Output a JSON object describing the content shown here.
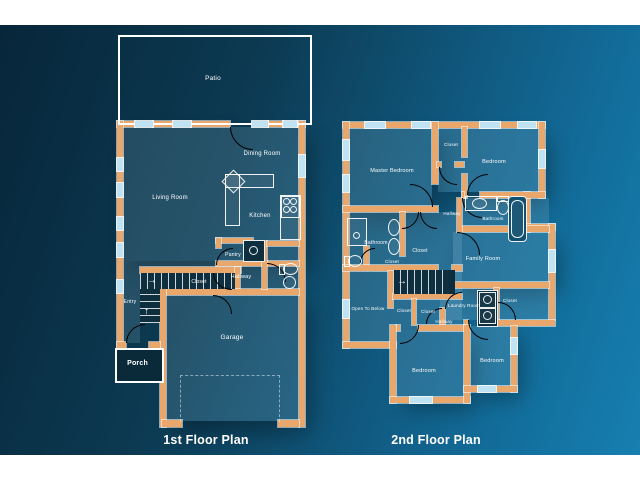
{
  "palette": {
    "background_dark": "#07263a",
    "background_light": "#1478a8",
    "letterbox": "#ffffff",
    "wall": "#e9a76c",
    "window": "#bfe3f2",
    "door_line": "#ffffff",
    "room_fill": "rgba(173,216,236,0.16)",
    "dark_fill": "#0c2d3e",
    "label_color": "#ffffff"
  },
  "floor1": {
    "title": "1st Floor Plan",
    "rooms": {
      "patio": "Patio",
      "dining_room": "Dining Room",
      "living_room": "Living Room",
      "kitchen": "Kitchen",
      "pantry": "Pantry",
      "hallway": "Hallway",
      "closet": "Closet",
      "entry": "Entry",
      "garage": "Garage",
      "porch": "Porch"
    }
  },
  "floor2": {
    "title": "2nd Floor Plan",
    "rooms": {
      "master_bedroom": "Master Bedroom",
      "closet_top": "Closet",
      "bedroom_top": "Bedroom",
      "hallway_upper": "Hallway",
      "bathroom_right": "Bathroom",
      "bathroom_left": "Bathroom",
      "closet_walkin": "Closet",
      "closet_small": "Closet",
      "family_room": "Family Room",
      "open_to_below": "Open To Below",
      "closet_a": "Closet",
      "closet_b": "Closet",
      "laundry_room": "Laundry Room",
      "closet_right": "Closet",
      "hallway_lower": "Hallway",
      "bedroom_left": "Bedroom",
      "bedroom_right": "Bedroom"
    }
  },
  "arrows": {
    "up": "↑",
    "right": "→"
  },
  "icons": {
    "stove-icon": "four burner circles",
    "sink-icon": "oval basin",
    "toilet-icon": "bowl with tank",
    "bathtub-icon": "rounded tub",
    "shower-icon": "square with drain",
    "washer-icon": "square with circle",
    "dryer-icon": "square with circle",
    "stairs-icon": "striped treads with arrow",
    "garage-door-icon": "dashed rectangle"
  }
}
